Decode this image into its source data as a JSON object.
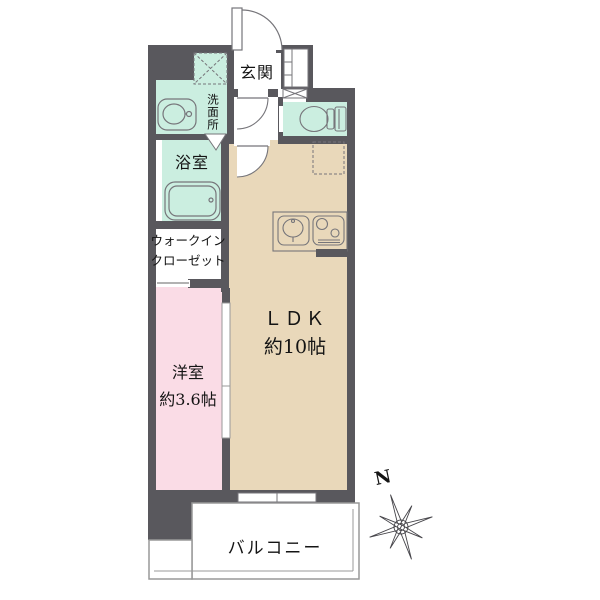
{
  "plan_type": "floor-plan",
  "rooms": {
    "entrance": {
      "label": "玄関"
    },
    "washroom": {
      "label": "洗面所"
    },
    "bathroom": {
      "label": "浴室"
    },
    "walk_in_closet": {
      "line1": "ウォークイン",
      "line2": "クローゼット"
    },
    "western_room": {
      "line1": "洋室",
      "line2": "約3.6帖"
    },
    "ldk": {
      "line1": "ＬＤＫ",
      "line2": "約10帖"
    },
    "balcony": {
      "label": "バルコニー"
    }
  },
  "compass": {
    "north_label": "N"
  },
  "icons": {
    "toilet": "toilet-icon",
    "bathtub": "bathtub-icon",
    "vanity_sink": "sink-icon",
    "kitchen_sink": "kitchen-sink-icon",
    "stove": "stove-icon",
    "washing_machine_space": "x-box-icon",
    "refrigerator_space": "dashed-box-icon",
    "shoe_cabinet": "cabinet-icon",
    "doors": "door-swing-icon",
    "compass_star": "compass-icon"
  },
  "colors": {
    "wall": "#59585d",
    "water": "#cbeee0",
    "bedroom": "#fadce6",
    "living": "#e9d8ba",
    "line": "#76757a",
    "thin": "#999999",
    "ink": "#141414"
  }
}
